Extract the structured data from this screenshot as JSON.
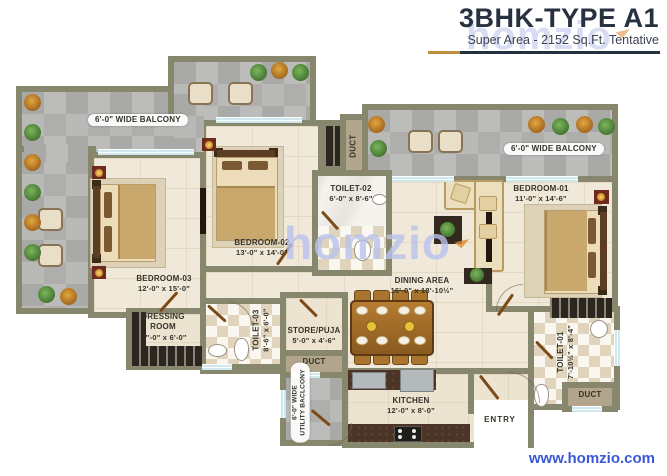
{
  "header": {
    "title": "3BHK-TYPE A1",
    "subtitle": "Super Area - 2152 Sq.Ft. Tentative"
  },
  "watermark": {
    "brand": "homzio",
    "footer_url": "www.homzio.com"
  },
  "rooms": {
    "balcony_left": {
      "label": "6'-0\" WIDE BALCONY"
    },
    "balcony_right": {
      "label": "6'-0\" WIDE BALCONY"
    },
    "bedroom01": {
      "name": "BEDROOM-01",
      "dims": "11'-0\" x 14'-6\""
    },
    "bedroom02": {
      "name": "BEDROOM-02",
      "dims": "13'-0\" x 14'-0\""
    },
    "bedroom03": {
      "name": "BEDROOM-03",
      "dims": "12'-0\" x 15'-0\""
    },
    "toilet01": {
      "name": "TOILET-01",
      "dims": "7'-10½\" x 8'-4\""
    },
    "toilet02": {
      "name": "TOILET-02",
      "dims": "6'-0\" x 8'-6\""
    },
    "toilet03": {
      "name": "TOILET-03",
      "dims": "8'-6\" x 6'-0\""
    },
    "dining": {
      "name": "DINING AREA",
      "dims": "16'-0\" x 18'-10½\""
    },
    "dressing": {
      "name": "DRESSING ROOM",
      "dims": "7'-0\" x 6'-0\""
    },
    "store_puja": {
      "name": "STORE/PUJA",
      "dims": "5'-0\" x 4'-6\""
    },
    "kitchen": {
      "name": "KITCHEN",
      "dims": "12'-0\" x 8'-0\""
    },
    "utility_balcony": {
      "line1": "6'-0\" WIDE",
      "line2": "UTILITY BACLCONY"
    },
    "duct_top": {
      "label": "DUCT"
    },
    "duct_mid": {
      "label": "DUCT"
    },
    "duct_bottom": {
      "label": "DUCT"
    },
    "entry": {
      "label": "ENTRY"
    }
  },
  "colors": {
    "wall": "#87876d",
    "accent_gold": "#bd8e3e",
    "accent_navy": "#22303f",
    "watermark": "#b9c2ec",
    "url_blue": "#3a57d6"
  }
}
